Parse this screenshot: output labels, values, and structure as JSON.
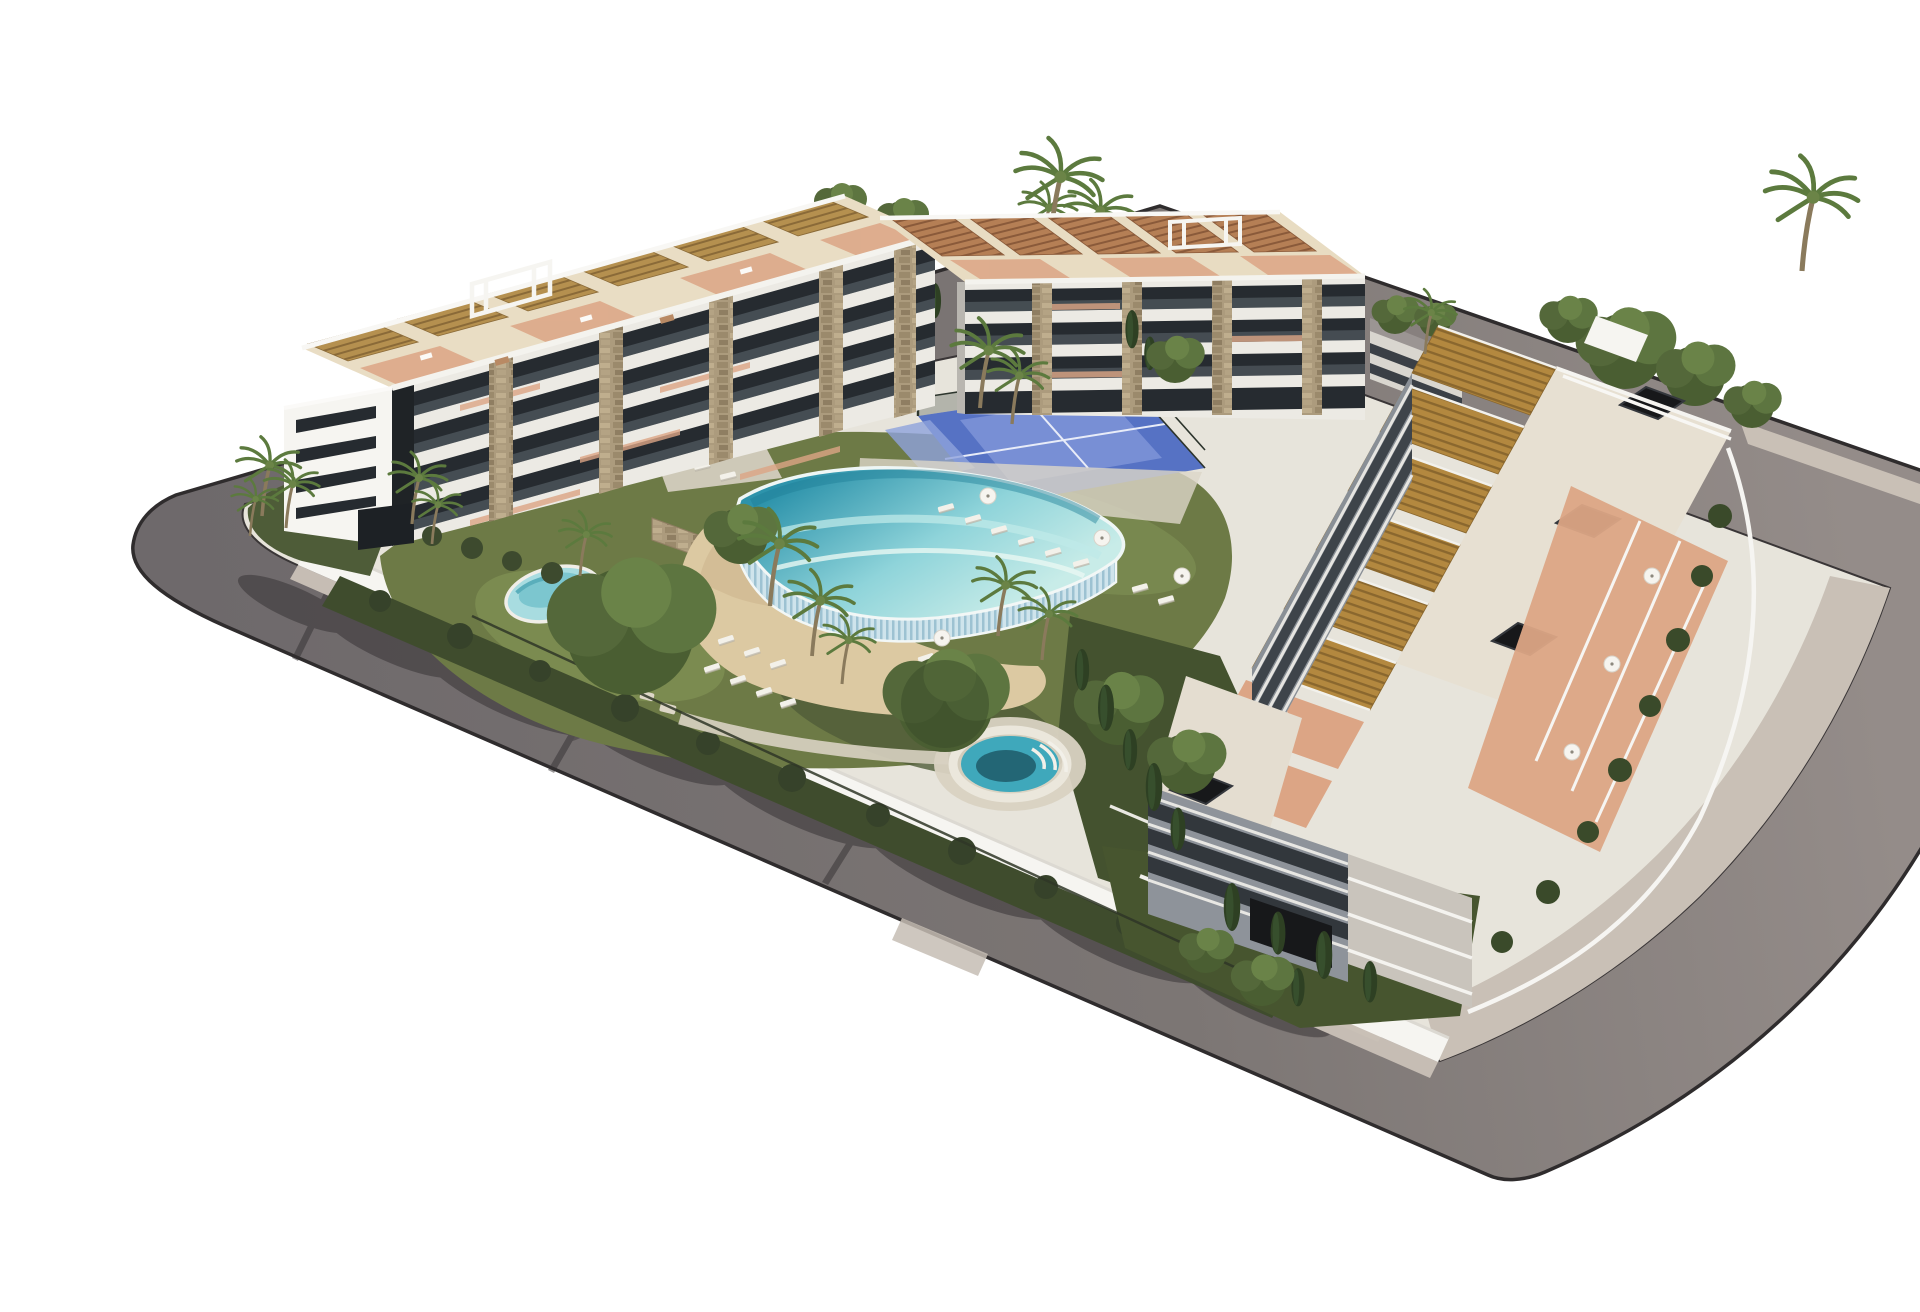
{
  "scene": {
    "type": "architectural-3d-rendering",
    "description": "Aerial 3D rendering of a modern white residential apartment complex on a rounded street block: three low-rise blocks with rooftop pergola terraces and black skylights around a landscaped courtyard with a lagoon-style pool with sand beach entry, a round spa pool, a small kidney pool, a blue padel court, palm trees, cypresses, sun loungers and parasols, encircled by a gray asphalt road with sidewalks and tree shadows on a white background.",
    "elements": [
      "ring-road",
      "sidewalk",
      "perimeter-wall",
      "apartment-building-left",
      "apartment-building-back",
      "apartment-building-right",
      "rooftop-pergolas",
      "rooftop-frames",
      "roof-skylights",
      "stone-piers",
      "balconies",
      "garage-entrance",
      "lagoon-pool",
      "infinity-edge",
      "beach-entry",
      "spa-pool",
      "kids-pool",
      "padel-court",
      "sun-loungers",
      "parasols",
      "palm-trees",
      "cypress-trees",
      "leafy-trees",
      "lawns",
      "hedge-fence",
      "tree-shadows",
      "paved-bay"
    ]
  },
  "colors": {
    "background": "#ffffff",
    "road": "#6e696b",
    "roadLight": "#948c89",
    "curb": "#2f2c2d",
    "sidewalk": "#c6bdb4",
    "apron": "#c9c0b6",
    "wallWhite": "#f6f5f1",
    "building": "#eceae4",
    "buildingShade": "#898f96",
    "glass": "#262b30",
    "stone": "#ac9b7d",
    "pergola": "#b5904f",
    "pergolaDark": "#8a6a38",
    "terracotta": "#dca585",
    "lawn": "#6d7a46",
    "lawnBright": "#7e8e52",
    "shrub": "#3f4c2d",
    "treeDark": "#44522f",
    "sand": "#dcc9a2",
    "poolDeep": "#2d93ab",
    "poolLight": "#8fd4da",
    "poolPale": "#c8ece8",
    "spa": "#3fa8bb",
    "padel": "#5672c4",
    "skylight": "#17181a",
    "shadow": "#332f31"
  }
}
